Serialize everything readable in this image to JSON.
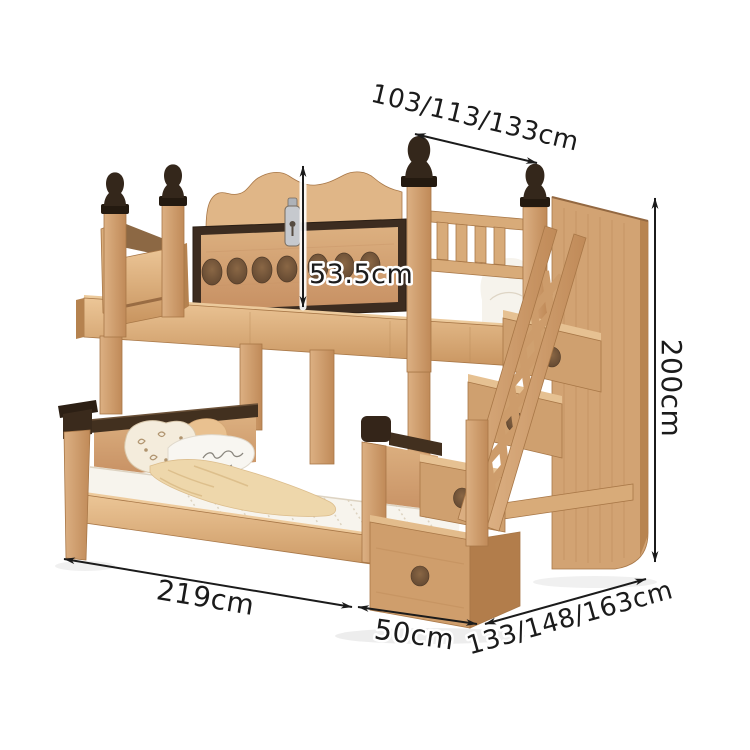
{
  "dimensions": {
    "top_width": "103/113/133cm",
    "guardrail_height": "53.5cm",
    "overall_height": "200cm",
    "bed_length": "219cm",
    "stair_depth": "50cm",
    "bottom_width": "133/148/163cm"
  },
  "colors": {
    "background": "#ffffff",
    "wood_light": "#e3bc8e",
    "wood_mid": "#cf9e6c",
    "wood_edge": "#a87747",
    "trim_dark": "#3c2c20",
    "finial_dark": "#34271b",
    "bedding_white": "#f7f4ed",
    "blanket_beige": "#eed7ab",
    "pillow_orange": "#e9c190",
    "metal_latch": "#c6c9ce",
    "dimension_ink": "#1b1b1b"
  }
}
